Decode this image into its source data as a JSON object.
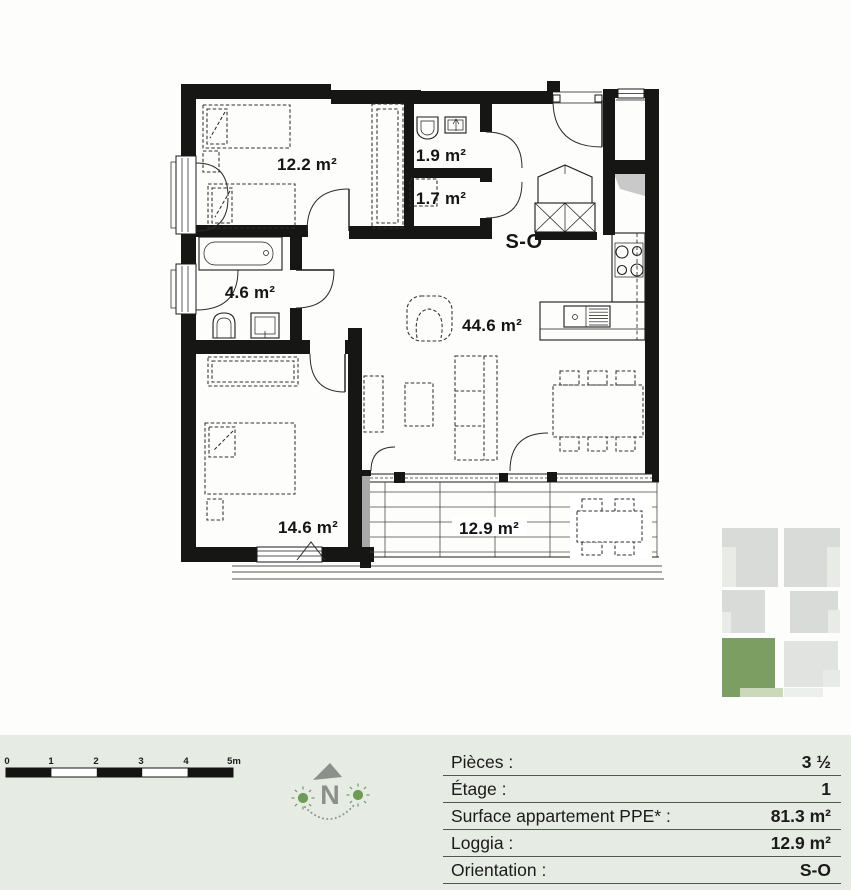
{
  "plan": {
    "orientation_label": "S-O",
    "room_labels": [
      {
        "id": "bedroom-1",
        "label": "12.2 m²"
      },
      {
        "id": "wc",
        "label": "1.9 m²"
      },
      {
        "id": "reduit",
        "label": "1.7 m²"
      },
      {
        "id": "bathroom",
        "label": "4.6 m²"
      },
      {
        "id": "living-dining-kitchen",
        "label": "44.6 m²"
      },
      {
        "id": "bedroom-2",
        "label": "14.6 m²"
      },
      {
        "id": "loggia",
        "label": "12.9 m²"
      }
    ]
  },
  "scale_bar": {
    "tick_labels": [
      "0",
      "1",
      "2",
      "3",
      "4",
      "5m"
    ]
  },
  "compass": {
    "north_label": "N"
  },
  "info_table": {
    "rows": [
      {
        "label": "Pièces :",
        "value": "3 ½"
      },
      {
        "label": "Étage :",
        "value": "1"
      },
      {
        "label": "Surface appartement PPE* :",
        "value": "81.3 m²"
      },
      {
        "label": "Loggia :",
        "value": "12.9 m²"
      },
      {
        "label": "Orientation :",
        "value": "S-O"
      }
    ]
  },
  "unit_locator": {
    "highlight_color": "#7d9e62",
    "highlight_light_color": "#cbd9ba",
    "unit_color": "#d9dbd8"
  },
  "colors": {
    "wall": "#161615",
    "footer_background": "#e6ebe4",
    "compass_gray": "#8b908b",
    "sun_green": "#6f9b55"
  }
}
